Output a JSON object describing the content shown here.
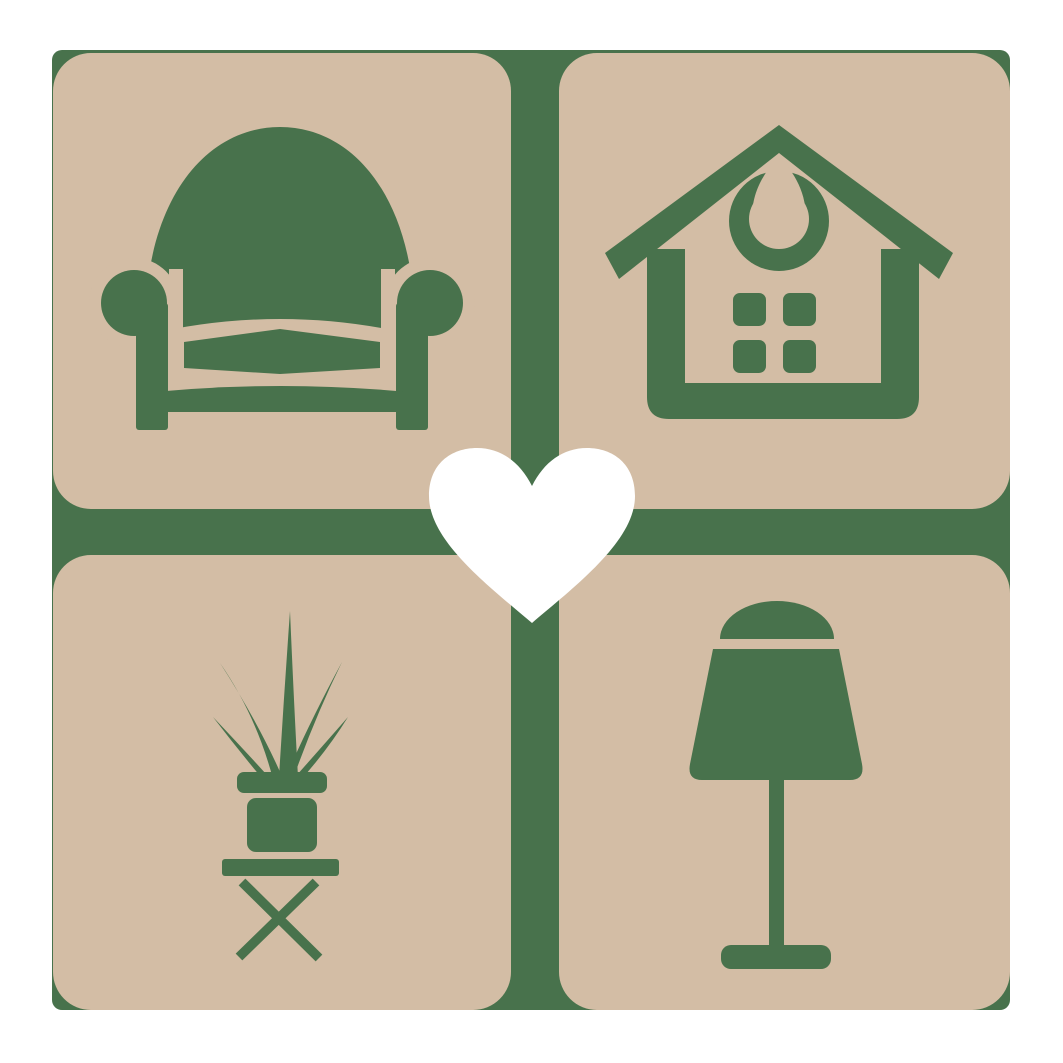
{
  "logo": {
    "name": "home-and-living-logo",
    "description": "Four rounded squares with furniture icons around a central heart on a green cross backdrop",
    "center_icon": "heart-icon",
    "tiles": [
      {
        "position": "top-left",
        "icon": "armchair-icon"
      },
      {
        "position": "top-right",
        "icon": "house-icon"
      },
      {
        "position": "bottom-left",
        "icon": "potted-plant-icon"
      },
      {
        "position": "bottom-right",
        "icon": "table-lamp-icon"
      }
    ]
  },
  "colors": {
    "icon-green": "#48724C",
    "tile-beige": "#D3BDA5",
    "heart-white": "#ffffff",
    "page-bg": "#ffffff"
  }
}
